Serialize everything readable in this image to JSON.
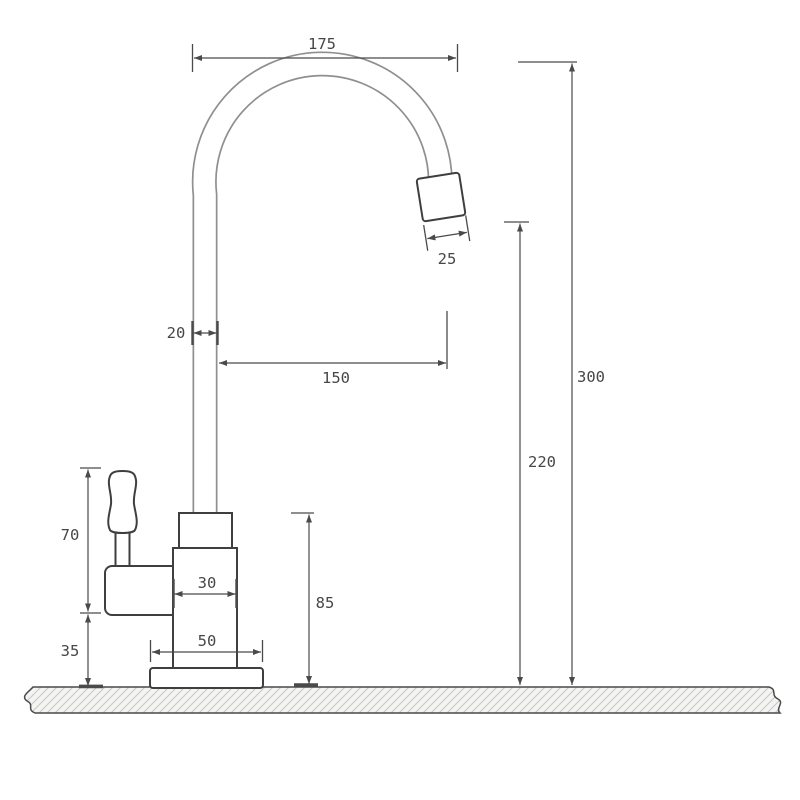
{
  "drawing": {
    "type": "dimensioned technical drawing",
    "subject": "gooseneck single-lever faucet, side elevation",
    "dimensions": {
      "spout_arc_width": "175",
      "aerator_width": "25",
      "pipe_width": "20",
      "spout_reach": "150",
      "total_height": "300",
      "outlet_height": "220",
      "handle_section_height": "70",
      "inlet_section_height": "35",
      "body_width": "30",
      "base_width": "50",
      "body_height": "85"
    },
    "colors": {
      "outline": "#3f3f3f",
      "tube_line": "#8f8f8f",
      "dimension_line": "#4a4a4a",
      "label_text": "#474747",
      "hatch_line": "#c7c7c5",
      "ground_fill": "#f4f4f3",
      "background": "#ffffff"
    }
  }
}
